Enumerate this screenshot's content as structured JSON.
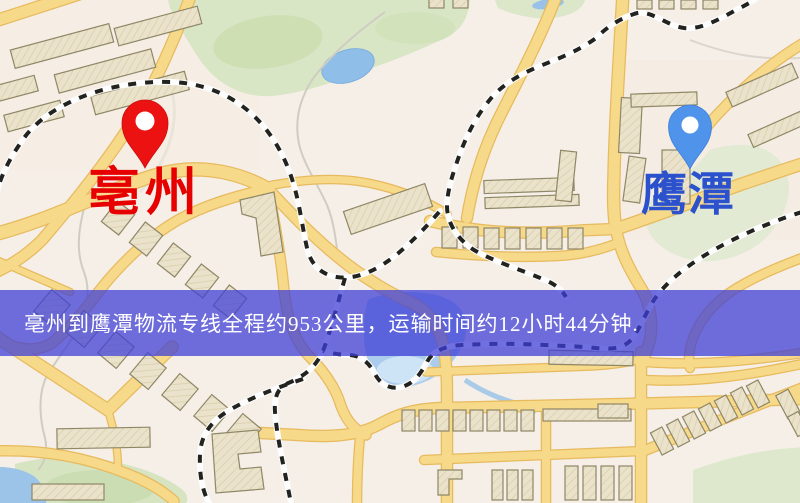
{
  "map": {
    "markers": {
      "origin": {
        "label": "亳州",
        "pin_color": "#ec1212",
        "label_color": "#e60000"
      },
      "destination": {
        "label": "鹰潭",
        "pin_color": "#4f93ea",
        "label_color": "#2b52cc"
      }
    },
    "banner": {
      "text": "亳州到鹰潭物流专线全程约953公里，运输时间约12小时44分钟.",
      "background_color": "#3e3ed7",
      "text_color": "#ffffff"
    },
    "route_info": {
      "origin": "亳州",
      "destination": "鹰潭",
      "distance": "约953公里",
      "duration": "约12小时44分钟"
    }
  }
}
